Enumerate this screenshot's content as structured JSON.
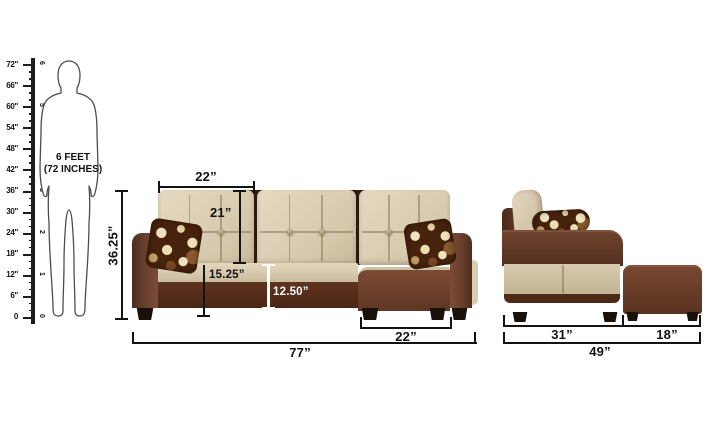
{
  "title": "Sofa dimensions diagram",
  "colors": {
    "bg": "#ffffff",
    "ink": "#131313",
    "beige-light": "#e6dac2",
    "beige": "#d6c8ac",
    "beige-dark": "#c8b89b",
    "brown": "#6b4130",
    "brown-light": "#7d4c38",
    "brown-dark": "#4f2c1d",
    "base-brown": "#572f1d",
    "foot-black": "#1a100a",
    "pillow-brown": "#47230e",
    "pillow-cream": "#f0e2bd"
  },
  "ruler": {
    "inch_labels": [
      "72\"",
      "66\"",
      "60\"",
      "54\"",
      "48\"",
      "42\"",
      "36\"",
      "30\"",
      "24\"",
      "18\"",
      "12\"",
      "6\"",
      "0"
    ],
    "feet_labels": [
      "6",
      "5",
      "4",
      "3",
      "2",
      "1",
      "0"
    ]
  },
  "figure": {
    "line1": "6 FEET",
    "line2": "(72 INCHES)"
  },
  "front_view": {
    "dims": {
      "cushion_width": "22”",
      "backrest_height": "21”",
      "seat_height": "15.25”",
      "base_height": "12.50”",
      "chaise_width": "22”",
      "overall_width": "77”",
      "overall_height": "36.25”"
    }
  },
  "side_view": {
    "dims": {
      "seat_depth": "31”",
      "ottoman_width": "18”",
      "overall_depth": "49”"
    }
  }
}
